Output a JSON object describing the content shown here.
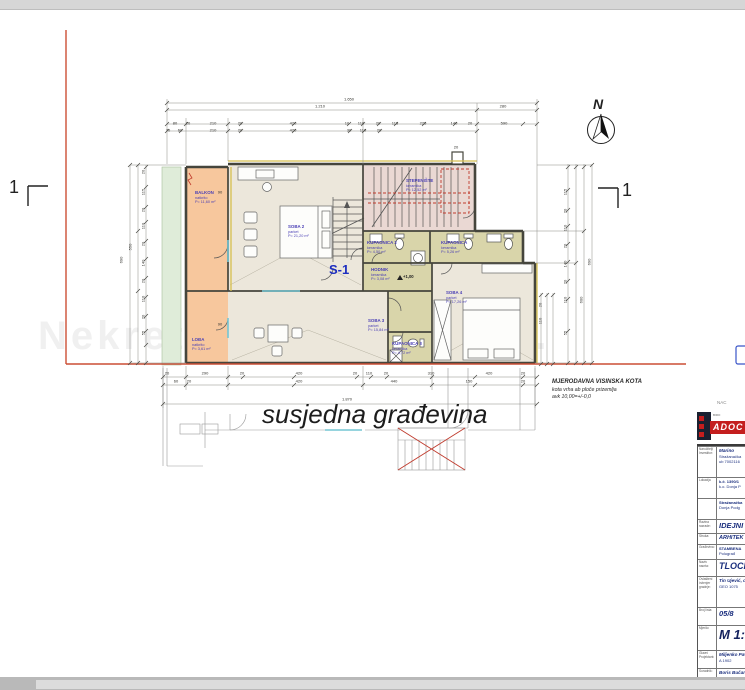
{
  "window": {
    "top_bar_color": "#d6d6d6",
    "bottom_bar_color": "#b9b9b9",
    "canvas_color": "#ffffff"
  },
  "watermark": {
    "text": "Nekretnine d.o.o."
  },
  "compass": {
    "label": "N"
  },
  "section_markers": {
    "left": "1",
    "right": "1"
  },
  "plan": {
    "unit_label": "S-1",
    "neighbor_label": "susjedna građevina",
    "elevation_label": "+1,00",
    "note": {
      "line1": "MJERODAVNA VISINSKA KOTA",
      "line2": "kota vrha ab ploče prizemlja",
      "line3": "avk 10,00=+/-0,0"
    },
    "colors": {
      "balcony": "#f7c79d",
      "room": "#ece7db",
      "bath": "#d9d5aa",
      "stair_room": "#ead8d3",
      "terrace": "#dfecd9",
      "boundary_red": "#cc4f35",
      "label_blue": "#4a3fb5",
      "window_cyan": "#74c6d4"
    },
    "rooms": [
      {
        "name": "BALKON",
        "floor": "natkrito",
        "area": "P= 11,60 m²",
        "x": 195,
        "y": 190
      },
      {
        "name": "SOBA 2",
        "floor": "parket",
        "area": "P= 21,20 m²",
        "x": 288,
        "y": 224
      },
      {
        "name": "STEPENIŠTE",
        "floor": "keramika",
        "area": "P= 12,52 m²",
        "x": 406,
        "y": 178
      },
      {
        "name": "KUPAONICA 2",
        "floor": "keramika",
        "area": "P= 4,50 m²",
        "x": 367,
        "y": 240
      },
      {
        "name": "KUPAONICA",
        "floor": "keramika",
        "area": "P= 5,26 m²",
        "x": 441,
        "y": 240
      },
      {
        "name": "HODNIK",
        "floor": "keramika",
        "area": "P= 3,08 m²",
        "x": 371,
        "y": 267
      },
      {
        "name": "LOĐA",
        "floor": "natkrito",
        "area": "P= 3,61 m²",
        "x": 192,
        "y": 337
      },
      {
        "name": "SOBA 3",
        "floor": "parket",
        "area": "P= 15,84 m²",
        "x": 368,
        "y": 318
      },
      {
        "name": "SOBA 4",
        "floor": "parket",
        "area": "P= 17,26 m²",
        "x": 446,
        "y": 290
      },
      {
        "name": "KUPAONICA 3",
        "floor": "keramika",
        "area": "P= 4,72 m²",
        "x": 392,
        "y": 341
      }
    ],
    "dims": [
      {
        "v": "1.650",
        "x": 349,
        "y": 99
      },
      {
        "v": "1.210",
        "x": 320,
        "y": 106
      },
      {
        "v": "280",
        "x": 503,
        "y": 106
      },
      {
        "v": "80",
        "x": 175,
        "y": 123
      },
      {
        "v": "20",
        "x": 188,
        "y": 123
      },
      {
        "v": "210",
        "x": 213,
        "y": 123
      },
      {
        "v": "20",
        "x": 240,
        "y": 123
      },
      {
        "v": "420",
        "x": 293,
        "y": 123
      },
      {
        "v": "10",
        "x": 347,
        "y": 123
      },
      {
        "v": "110",
        "x": 361,
        "y": 123
      },
      {
        "v": "20",
        "x": 378,
        "y": 123
      },
      {
        "v": "115",
        "x": 395,
        "y": 123
      },
      {
        "v": "225",
        "x": 423,
        "y": 123
      },
      {
        "v": "140",
        "x": 454,
        "y": 123
      },
      {
        "v": "20",
        "x": 470,
        "y": 123
      },
      {
        "v": "590",
        "x": 504,
        "y": 123
      },
      {
        "v": "70",
        "x": 168,
        "y": 130
      },
      {
        "v": "60",
        "x": 180,
        "y": 130
      },
      {
        "v": "210",
        "x": 213,
        "y": 130
      },
      {
        "v": "20",
        "x": 240,
        "y": 130
      },
      {
        "v": "420",
        "x": 293,
        "y": 130
      },
      {
        "v": "30",
        "x": 349,
        "y": 130
      },
      {
        "v": "110",
        "x": 363,
        "y": 130
      },
      {
        "v": "20",
        "x": 379,
        "y": 130
      },
      {
        "v": "690",
        "x": 121,
        "y": 260,
        "r": 1
      },
      {
        "v": "550",
        "x": 130,
        "y": 247,
        "r": 1
      },
      {
        "v": "20",
        "x": 143,
        "y": 172,
        "r": 1
      },
      {
        "v": "115",
        "x": 143,
        "y": 192,
        "r": 1
      },
      {
        "v": "20",
        "x": 143,
        "y": 210,
        "r": 1
      },
      {
        "v": "110",
        "x": 143,
        "y": 226,
        "r": 1
      },
      {
        "v": "20",
        "x": 143,
        "y": 244,
        "r": 1
      },
      {
        "v": "140",
        "x": 143,
        "y": 263,
        "r": 1
      },
      {
        "v": "20",
        "x": 143,
        "y": 281,
        "r": 1
      },
      {
        "v": "110",
        "x": 143,
        "y": 299,
        "r": 1
      },
      {
        "v": "20",
        "x": 143,
        "y": 317,
        "r": 1
      },
      {
        "v": "55",
        "x": 143,
        "y": 333,
        "r": 1
      },
      {
        "v": "115",
        "x": 565,
        "y": 192,
        "r": 1
      },
      {
        "v": "20",
        "x": 565,
        "y": 211,
        "r": 1
      },
      {
        "v": "110",
        "x": 565,
        "y": 228,
        "r": 1
      },
      {
        "v": "20",
        "x": 565,
        "y": 246,
        "r": 1
      },
      {
        "v": "140",
        "x": 565,
        "y": 264,
        "r": 1
      },
      {
        "v": "20",
        "x": 565,
        "y": 282,
        "r": 1
      },
      {
        "v": "110",
        "x": 565,
        "y": 300,
        "r": 1
      },
      {
        "v": "55",
        "x": 565,
        "y": 333,
        "r": 1
      },
      {
        "v": "600",
        "x": 581,
        "y": 300,
        "r": 1
      },
      {
        "v": "690",
        "x": 589,
        "y": 262,
        "r": 1
      },
      {
        "v": "20",
        "x": 167,
        "y": 373
      },
      {
        "v": "290",
        "x": 205,
        "y": 373
      },
      {
        "v": "20",
        "x": 242,
        "y": 373
      },
      {
        "v": "420",
        "x": 299,
        "y": 373
      },
      {
        "v": "20",
        "x": 355,
        "y": 373
      },
      {
        "v": "110",
        "x": 369,
        "y": 373
      },
      {
        "v": "20",
        "x": 386,
        "y": 373
      },
      {
        "v": "310",
        "x": 431,
        "y": 373
      },
      {
        "v": "420",
        "x": 489,
        "y": 373
      },
      {
        "v": "20",
        "x": 523,
        "y": 373
      },
      {
        "v": "60",
        "x": 176,
        "y": 381
      },
      {
        "v": "20",
        "x": 189,
        "y": 381
      },
      {
        "v": "420",
        "x": 299,
        "y": 381
      },
      {
        "v": "440",
        "x": 394,
        "y": 381
      },
      {
        "v": "150",
        "x": 469,
        "y": 381
      },
      {
        "v": "20",
        "x": 523,
        "y": 381
      },
      {
        "v": "1.870",
        "x": 347,
        "y": 399
      },
      {
        "v": "20",
        "x": 540,
        "y": 305,
        "r": 1
      },
      {
        "v": "110",
        "x": 540,
        "y": 321,
        "r": 1
      },
      {
        "v": "90",
        "x": 220,
        "y": 192
      },
      {
        "v": "90",
        "x": 220,
        "y": 324
      },
      {
        "v": "20",
        "x": 456,
        "y": 147
      }
    ]
  },
  "title_block": {
    "corner_text": "NAC",
    "logo": {
      "brand": "ADOC",
      "side": "BIRO"
    },
    "rows": [
      {
        "label": "Naručitelj/ Investitor:",
        "lines": [
          "Marino",
          "Stražanačka",
          "ub 7002116"
        ],
        "cls": "sm",
        "h": 30
      },
      {
        "label": "Lokacija",
        "lines": [
          "k.č. 1390/1",
          "k.o. Donja P"
        ],
        "cls": "smb",
        "h": 20
      },
      {
        "label": "",
        "lines": [
          "Stražanačka",
          "Donja Podg"
        ],
        "cls": "smb",
        "h": 20
      },
      {
        "label": "Razina razrade:",
        "lines": [
          "IDEJNI"
        ],
        "cls": "lg",
        "h": 13
      },
      {
        "label": "Struka:",
        "lines": [
          "ARHITEK"
        ],
        "cls": "md",
        "h": 10
      },
      {
        "label": "Građevina:",
        "lines": [
          "STAMBENA",
          "Polugrađ"
        ],
        "cls": "smb",
        "h": 14
      },
      {
        "label": "Naziv nacrta:",
        "lines": [
          "TLOCR"
        ],
        "cls": "xl",
        "h": 16
      },
      {
        "label": "Ovlašteni inženjer gradnje:",
        "lines": [
          "Tin Ujević, dipl. i",
          "GEO 1075"
        ],
        "cls": "sm",
        "h": 30
      },
      {
        "label": "Broj lista:",
        "lines": [
          "05/8"
        ],
        "cls": "lg",
        "h": 17
      },
      {
        "label": "Mjerilo:",
        "lines": [
          "M 1:1"
        ],
        "cls": "xxl",
        "h": 24
      },
      {
        "label": "Glavni Projektant:",
        "lines": [
          "Miljenko Pavić d",
          "A 1902"
        ],
        "cls": "sm",
        "h": 17
      },
      {
        "label": "Suradnik:",
        "lines": [
          "Boris Bučan, dip"
        ],
        "cls": "sm",
        "h": 10
      }
    ]
  }
}
